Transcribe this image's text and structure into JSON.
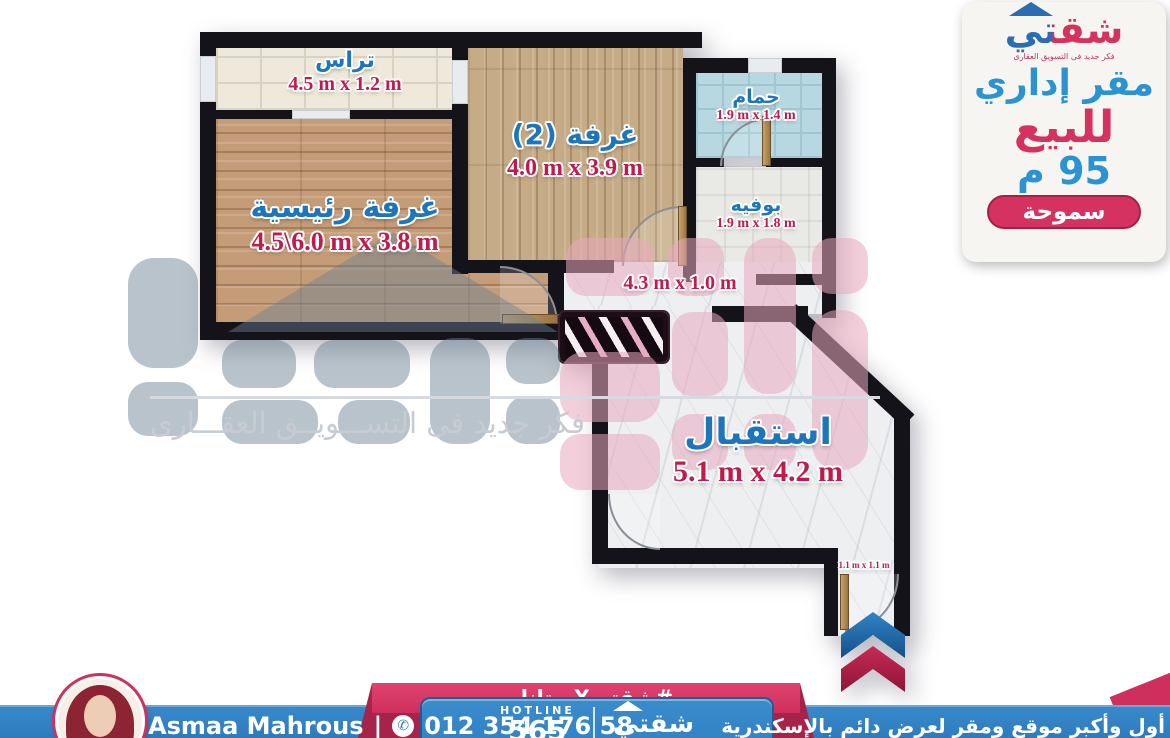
{
  "brand": {
    "logo_text": "شقتي",
    "tagline": "فكر جديد فى التسويق العقارى"
  },
  "side_panel": {
    "property_type": "مقر إداري",
    "offer": "للبيع",
    "area": "95 م",
    "location": "سموحة"
  },
  "floor_plan": {
    "terrace": {
      "name": "تراس",
      "dims": "4.5 m x 1.2 m"
    },
    "room2": {
      "name": "غرفة (2)",
      "dims": "4.0 m x 3.9 m"
    },
    "master": {
      "name": "غرفة رئيسية",
      "dims": "4.5\\6.0 m x 3.8 m"
    },
    "bathroom": {
      "name": "حمام",
      "dims": "1.9 m x 1.4 m"
    },
    "buffet": {
      "name": "بوفيه",
      "dims": "1.9 m x 1.8 m"
    },
    "corridor": {
      "dims": "4.3 m x 1.0 m"
    },
    "reception": {
      "name": "استقبال",
      "dims": "5.1 m x 4.2 m"
    },
    "entry": {
      "dims": "1.1 m x 1.1 m"
    }
  },
  "watermark": {
    "tagline": "فكر جديد فى التســـويــق العقـــارى"
  },
  "footer": {
    "hashtag": "#شقتيXستانلي",
    "hotline_label": "HOTLINE",
    "hotline_number_partial": "565",
    "logo_text": "شقتي",
    "agent_name": "Asmaa Mahrous",
    "agent_phone": "012 354 176 58",
    "slogan": "أول وأكبر موقع ومقر لعرض دائم بالإسكندرية"
  }
}
